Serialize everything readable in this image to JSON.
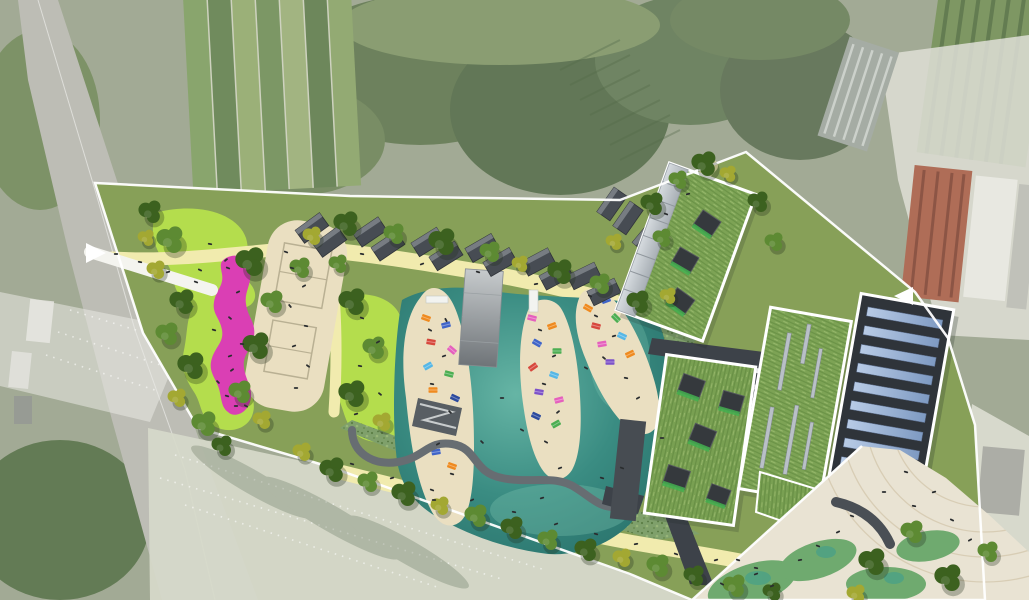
{
  "image_type": "landscape-architecture masterplan, aerial photomontage site plan (no visible text in image)",
  "visible_text": [],
  "palette": {
    "aerial_base": "#97a089",
    "aerial_veg_dark": "#55684a",
    "aerial_veg_mid": "#728a5b",
    "road": "#b6b6ae",
    "washed": "#dcdcd3",
    "red_roof": "#a65a42",
    "site_lawn": "#87a058",
    "bright_lawn": "#b4dd4d",
    "scrub": "#7fa06b",
    "tree_dark": "#3c611f",
    "tree_mid": "#5d8a33",
    "tree_olive": "#a3a832",
    "sand_path": "#f1ebae",
    "beach_sand": "#eadfc1",
    "water_deep": "#2a746d",
    "water_mid": "#3a8c82",
    "water_light": "#66b5a5",
    "magenta": "#da3fb4",
    "cabin": "#474c53",
    "deck_light": "#c6cacc",
    "deck_dark": "#6f7478",
    "boardwalk": "#676d72",
    "green_roof": "#7da355",
    "roof_dark": "#3d4249",
    "solar_panel": "#a9bedd",
    "glass": "#c7cdd2",
    "skylight_green": "#43af4f",
    "plaza": "#e9e3d3",
    "plaza_arc": "#d5c9af",
    "boundary": "#ffffff",
    "person": "#2b2e30",
    "towel_orange": "#ef8a1f",
    "towel_red": "#d7483d",
    "towel_blue": "#3f64c8",
    "towel_sky": "#56b7e6",
    "towel_green": "#4cae52",
    "towel_pink": "#e560bd",
    "towel_purple": "#7d52c9",
    "towel_navy": "#2c4a9e"
  },
  "features": {
    "site": {
      "boundary": "white outline polygon around park site",
      "entry_arrows": 2
    },
    "pool": {
      "label": "natural swimming lagoon",
      "islands": 3,
      "sunbather_towels": 30,
      "deck_bridge": 1,
      "piers": 4,
      "boardwalk": "serpentine timber walk through wetland fringe"
    },
    "play": {
      "playground": "magenta soft-surface play strip with figures",
      "beach_courts": 2
    },
    "cabins": {
      "count": 15,
      "label": "dark changing cabins along north sand path with trees"
    },
    "buildings": {
      "green_roof_count": 3,
      "skylights_building_ne": 3,
      "skylights_building_mid": 5,
      "linear_skylights": 6,
      "solar_panel_rows": 11,
      "service_roof_skylights": 6
    },
    "plaza": {
      "label": "south-east paved plaza with concentric arc pattern",
      "trees": 5
    },
    "context": {
      "road": "existing road along west edge",
      "allotments": "allotment garden strips at top left",
      "red_roof_building": "existing red-roofed building top right",
      "washed_field": "faded existing meadow bottom left with dotted guide lines"
    }
  }
}
